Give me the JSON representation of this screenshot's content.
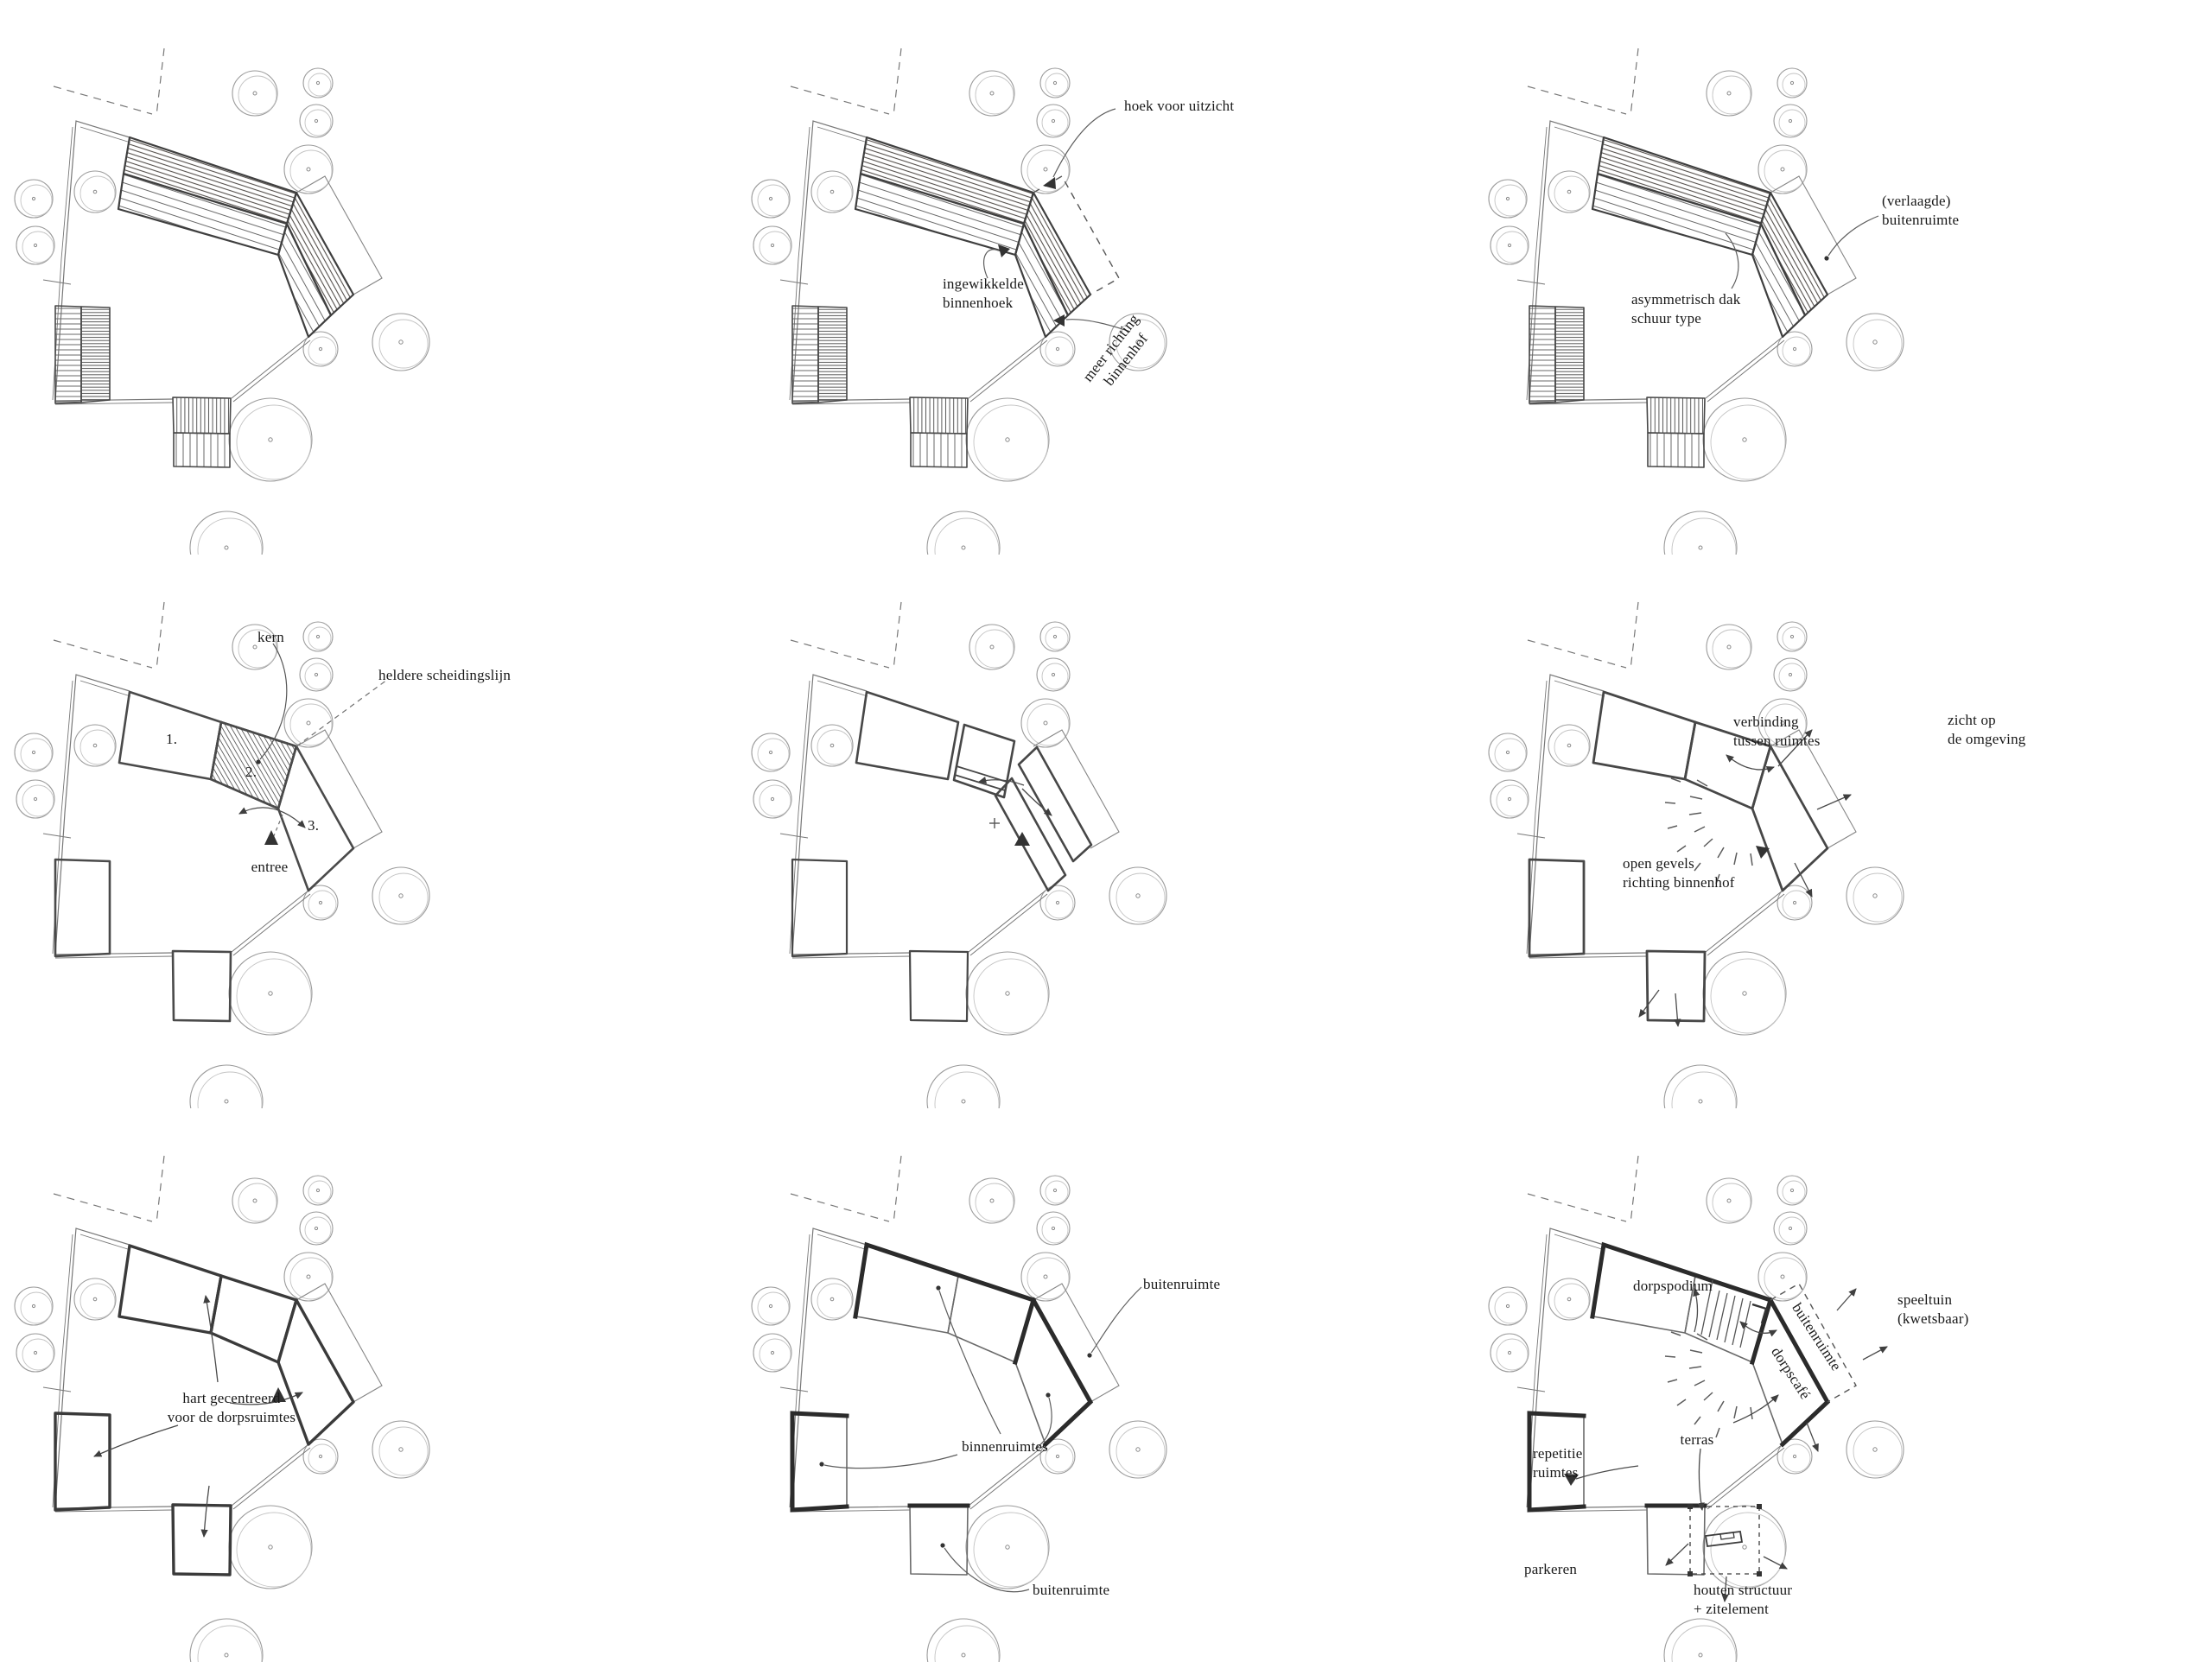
{
  "colors": {
    "ink": "#3a3a3a",
    "pencil": "#8f8f8f",
    "paper": "#ffffff"
  },
  "panels": [
    {
      "id": "schets-1-dakvorm",
      "annotations": []
    },
    {
      "id": "schets-2-binnenhof",
      "annotations": [
        {
          "text": "hoek voor uitzicht"
        },
        {
          "text": "ingewikkelde\nbinnenhoek"
        },
        {
          "text": "meer richting\nbinnenhof"
        }
      ]
    },
    {
      "id": "schets-3-dak-type",
      "annotations": [
        {
          "text": "(verlaagde)\nbuitenruimte"
        },
        {
          "text": "asymmetrisch dak\nschuur type"
        }
      ]
    },
    {
      "id": "schets-4-kern",
      "annotations": [
        {
          "text": "kern"
        },
        {
          "text": "heldere scheidingslijn"
        },
        {
          "text": "1."
        },
        {
          "text": "2."
        },
        {
          "text": "3."
        },
        {
          "text": "entree"
        }
      ]
    },
    {
      "id": "schets-5-verbindingen",
      "annotations": []
    },
    {
      "id": "schets-6-open-gevels",
      "annotations": [
        {
          "text": "verbinding\ntussen ruimtes"
        },
        {
          "text": "zicht op\nde omgeving"
        },
        {
          "text": "open gevels\nrichting binnenhof"
        }
      ]
    },
    {
      "id": "schets-7-hart",
      "annotations": [
        {
          "text": "hart gecentreerd\nvoor de dorpsruimtes"
        }
      ]
    },
    {
      "id": "schets-8-ruimtes",
      "annotations": [
        {
          "text": "buitenruimte"
        },
        {
          "text": "binnenruimtes"
        },
        {
          "text": "buitenruimte"
        }
      ]
    },
    {
      "id": "schets-9-programma",
      "annotations": [
        {
          "text": "dorpspodium"
        },
        {
          "text": "speeltuin\n(kwetsbaar)"
        },
        {
          "text": "buitenruimte"
        },
        {
          "text": "dorpscafé"
        },
        {
          "text": "repetitie\nruimtes"
        },
        {
          "text": "terras"
        },
        {
          "text": "parkeren"
        },
        {
          "text": "houten structuur\n+ zitelement"
        }
      ]
    }
  ]
}
